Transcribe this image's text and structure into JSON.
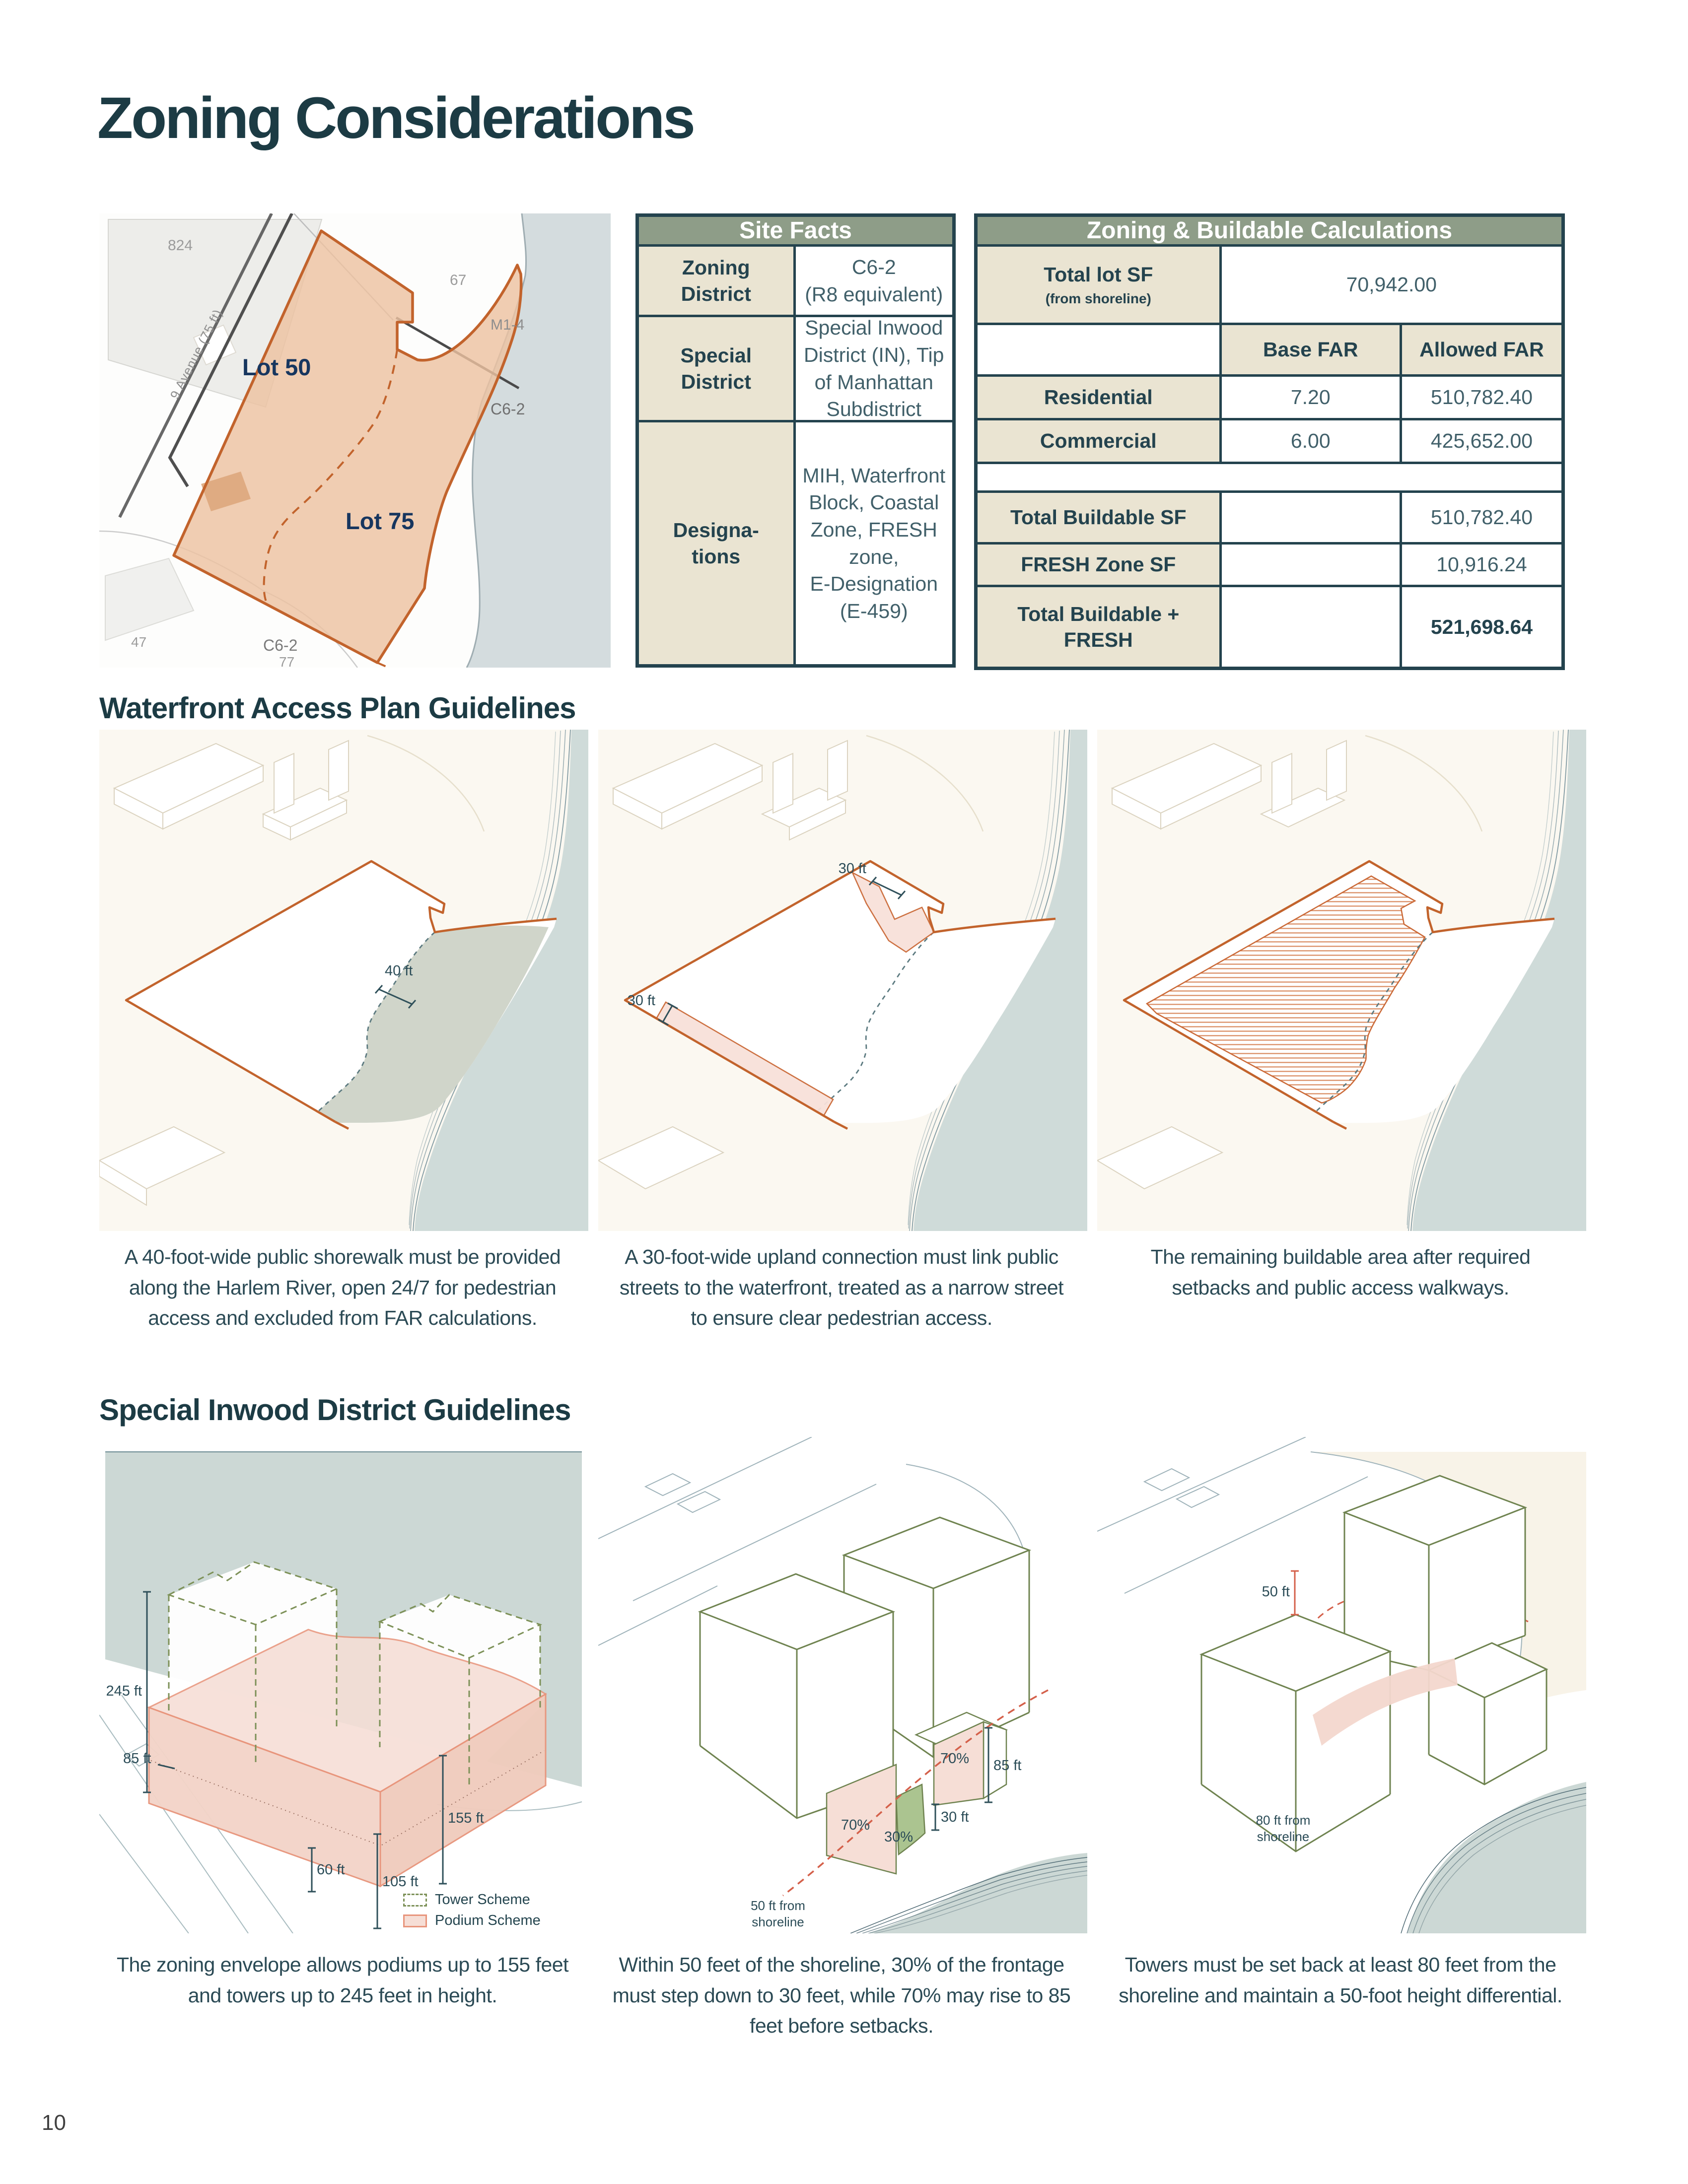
{
  "page": {
    "title": "Zoning Considerations",
    "number": "10"
  },
  "colors": {
    "accent_orange": "#c2632c",
    "header_green": "#8e9d88",
    "dark_teal": "#24434e",
    "beige": "#eae4d2",
    "water": "#cfdbd9",
    "podium_pink": "#f6ded6",
    "tower_green": "#6f8350",
    "highlight_red": "#d4604a",
    "lot_fill": "#edc2a1",
    "lot_label_blue": "#17365f"
  },
  "map": {
    "lot50": "Lot 50",
    "lot75": "Lot 75",
    "parcel_824": "824",
    "parcel_67": "67",
    "parcel_47": "47",
    "parcel_77": "77",
    "district_m1": "M1-4",
    "district_c62_shore": "C6-2",
    "district_c62_inland": "C6-2",
    "street": "9 Avenue (75 ft)"
  },
  "site_facts": {
    "title": "Site Facts",
    "rows": [
      {
        "label": "Zoning\nDistrict",
        "value": "C6-2\n(R8 equivalent)"
      },
      {
        "label": "Special\nDistrict",
        "value": "Special Inwood\nDistrict (IN), Tip\nof Manhattan\nSubdistrict"
      },
      {
        "label": "Designa-\ntions",
        "value": "MIH, Waterfront\nBlock, Coastal\nZone, FRESH zone,\nE-Designation\n(E-459)"
      }
    ]
  },
  "calc_table": {
    "title": "Zoning & Buildable Calculations",
    "total_lot": {
      "label": "Total lot SF",
      "label_sub": "(from shoreline)",
      "value": "70,942.00"
    },
    "col_headers": {
      "base": "Base FAR",
      "allowed": "Allowed FAR"
    },
    "far_rows": [
      {
        "label": "Residential",
        "base": "7.20",
        "allowed": "510,782.40"
      },
      {
        "label": "Commercial",
        "base": "6.00",
        "allowed": "425,652.00"
      }
    ],
    "summary_rows": [
      {
        "label": "Total Buildable SF",
        "value": "510,782.40"
      },
      {
        "label": "FRESH Zone SF",
        "value": "10,916.24"
      },
      {
        "label": "Total Buildable +\nFRESH",
        "value": "521,698.64"
      }
    ]
  },
  "waterfront": {
    "heading": "Waterfront Access Plan Guidelines",
    "panel1": {
      "dim": "40 ft",
      "caption": "A 40-foot-wide public shorewalk must be provided along the Harlem River, open 24/7 for pedestrian access and excluded from FAR calculations."
    },
    "panel2": {
      "dim_top": "30 ft",
      "dim_left": "30 ft",
      "caption": "A 30-foot-wide upland connection must link public streets to the waterfront, treated as a narrow street to ensure clear pedestrian access."
    },
    "panel3": {
      "caption": "The remaining buildable area after required setbacks and public access walkways."
    }
  },
  "inwood": {
    "heading": "Special Inwood District Guidelines",
    "panel1": {
      "dims": {
        "h245": "245 ft",
        "h85": "85 ft",
        "h155": "155 ft",
        "h60": "60 ft",
        "h105": "105 ft"
      },
      "legend": {
        "tower": "Tower Scheme",
        "podium": "Podium Scheme"
      },
      "caption": "The zoning envelope allows podiums up to 155 feet and towers up to 245 feet in height."
    },
    "panel2": {
      "dims": {
        "h85": "85 ft",
        "h30": "30 ft",
        "p70_left": "70%",
        "p70_right": "70%",
        "p30": "30%"
      },
      "note": "50 ft from shoreline",
      "caption": "Within 50 feet of the shoreline, 30% of the frontage must step down to 30 feet, while 70% may rise to 85 feet before setbacks."
    },
    "panel3": {
      "dims": {
        "h50": "50 ft"
      },
      "note": "80 ft from shoreline",
      "caption": "Towers must be set back at least 80 feet from the shoreline and maintain a 50-foot height differential."
    }
  }
}
